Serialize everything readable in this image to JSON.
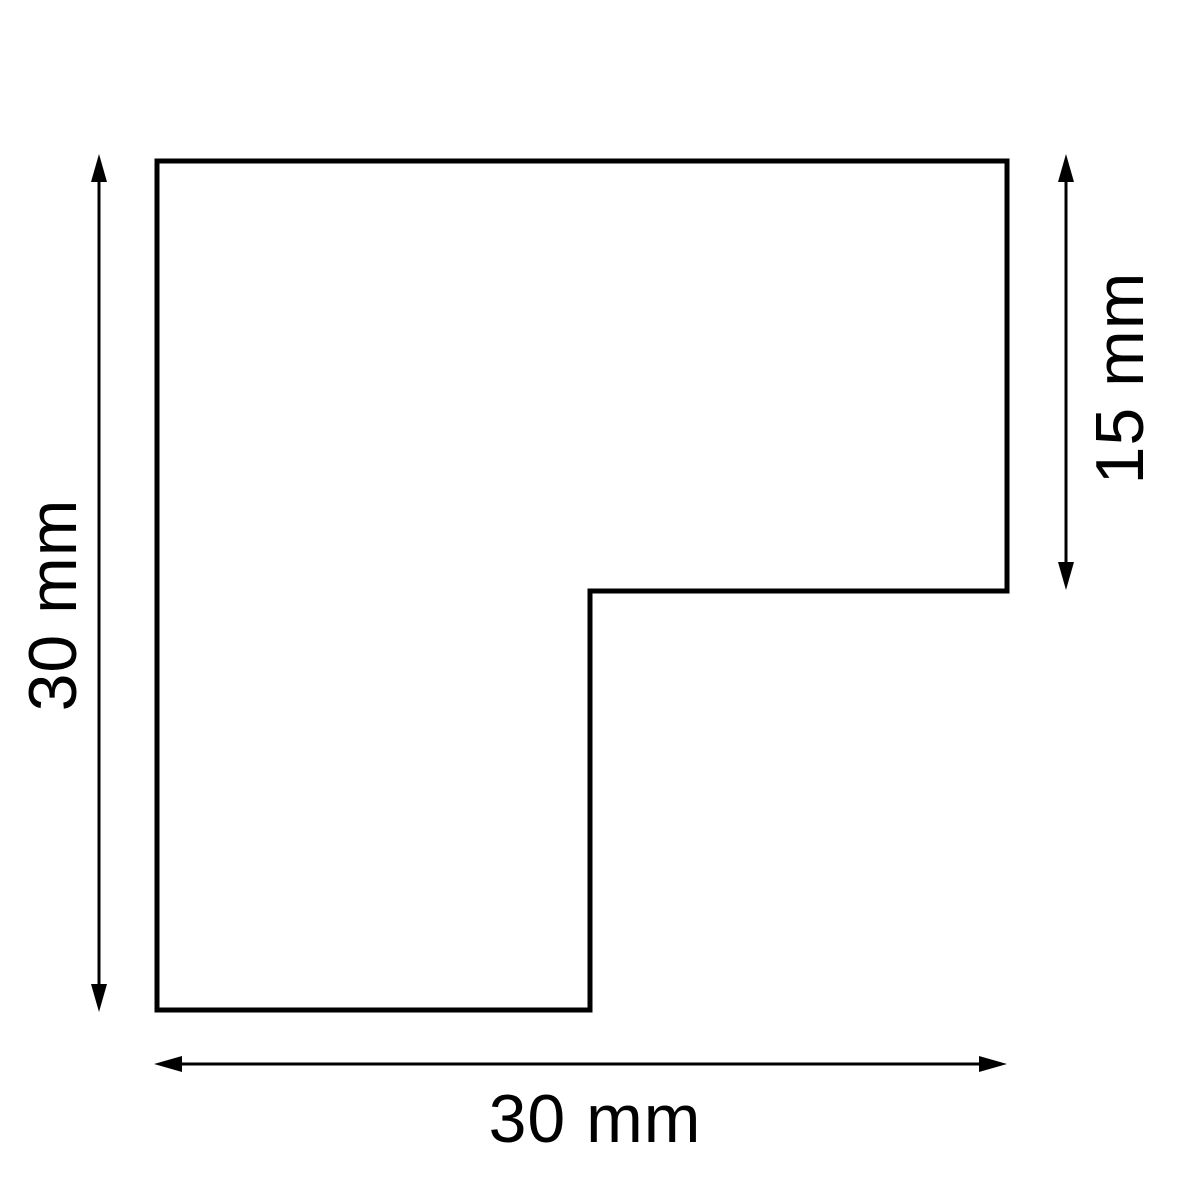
{
  "drawing": {
    "background_color": "#ffffff",
    "line_color": "#000000",
    "shape": {
      "kind": "l-shaped-outline",
      "fill": "#ffffff"
    },
    "dimensions": [
      {
        "side": "left",
        "label": "30 mm",
        "value": 30,
        "unit": "mm",
        "arrow": "vertical-double-arrow"
      },
      {
        "side": "right",
        "label": "15 mm",
        "value": 15,
        "unit": "mm",
        "arrow": "vertical-double-arrow"
      },
      {
        "side": "bottom",
        "label": "30 mm",
        "value": 30,
        "unit": "mm",
        "arrow": "horizontal-double-arrow"
      }
    ]
  }
}
